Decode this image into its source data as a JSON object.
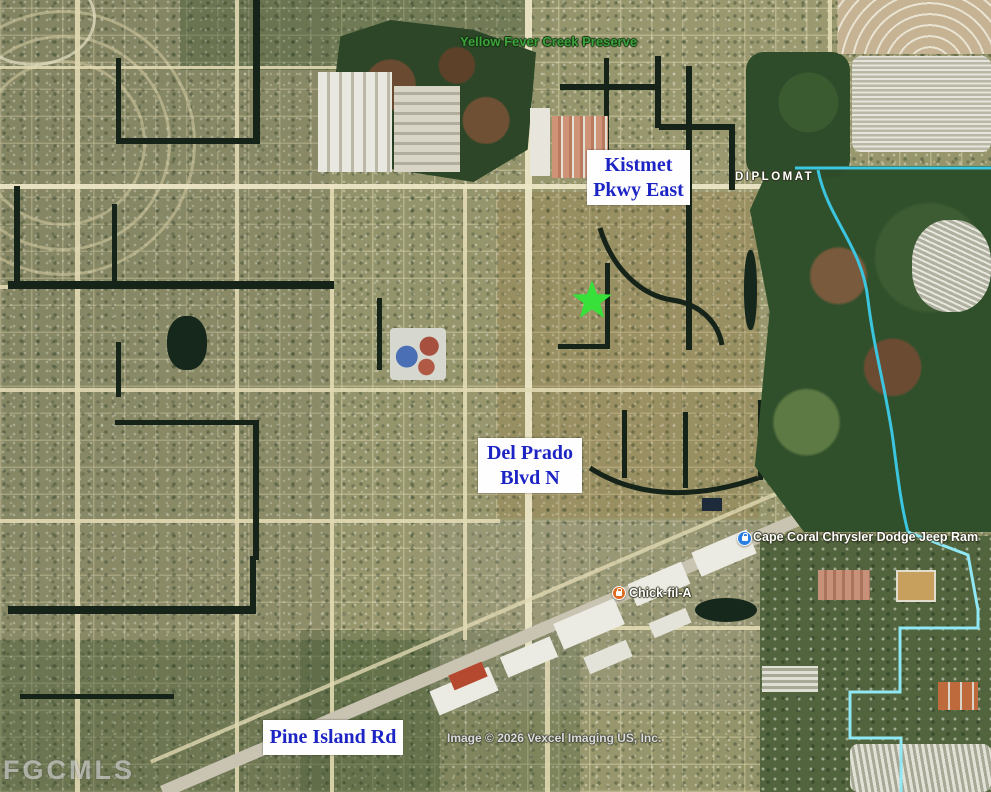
{
  "map": {
    "labels": {
      "preserve": "Yellow Fever Creek Preserve",
      "diplomat": "DIPLOMAT",
      "sign_kistmet_line1": "Kistmet",
      "sign_kistmet_line2": "Pkwy East",
      "sign_delprado_line1": "Del Prado",
      "sign_delprado_line2": "Blvd N",
      "sign_pineisland": "Pine Island Rd",
      "poi_dealership": "Cape Coral Chrysler Dodge Jeep Ram",
      "poi_restaurant": "Chick-fil-A",
      "attribution": "Image © 2026 Vexcel Imaging US, Inc.",
      "watermark": "FGCMLS"
    },
    "marker": {
      "type": "star",
      "color": "#38e03a",
      "outline": "#1fae24"
    },
    "colors": {
      "sign_text": "#1d24c4",
      "preserve_text": "#3da23d",
      "dealership_pin": "#2a7de1",
      "restaurant_pin": "#dd6b1f",
      "creek_line": "#3cc5de",
      "boundary_line": "#8fe8f4",
      "canal_water": "#152319"
    }
  }
}
